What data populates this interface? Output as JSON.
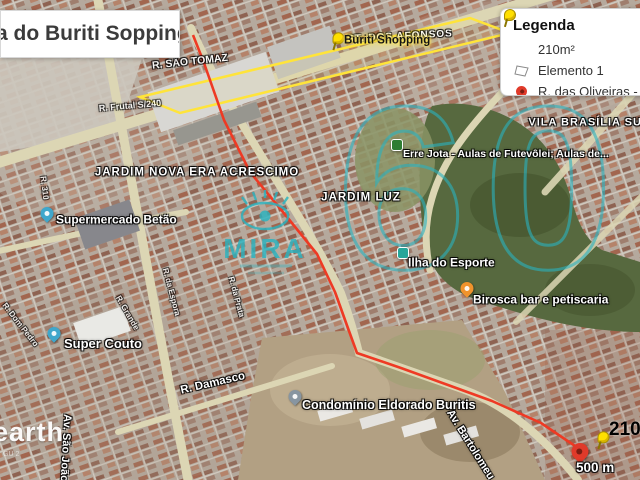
{
  "title": {
    "text": "a do Buriti Sopping"
  },
  "legend": {
    "heading": "Legenda",
    "items": [
      {
        "icon": "yellow-pushpin-icon",
        "label": "210m²"
      },
      {
        "icon": "polygon-icon",
        "label": "Elemento 1"
      },
      {
        "icon": "red-pin-icon",
        "label": "R. das Oliveiras - Jard"
      }
    ]
  },
  "map": {
    "areas": {
      "st_dos_afonsos": "ST. DOS AFONSOS",
      "vila_brasilia_sul": "VILA BRASÍLIA SUL",
      "jardim_nova_era": "JARDIM NOVA ERA ACRESCIMO",
      "jardim_luz": "JARDIM LUZ"
    },
    "streets": {
      "r_sao_tomaz": "R. SÃO TOMAZ",
      "r_frutal": "R. Frutal S/240",
      "r_damasco": "R. Damasco",
      "av_sao_joao": "Av. São João",
      "av_bartolomeu": "Av. Bartolomeu",
      "r_da_espora": "R. da Espora",
      "r_da_prata": "R. da Prata",
      "r_dom_pedro": "R. Dom Pedro",
      "r_grande": "R. Grande",
      "r_310": "R. 310"
    },
    "pois": {
      "buriti_shopping": "Buriti Shopping",
      "supermercado_betao": "Supermercado Betão",
      "super_couto": "Super Couto",
      "ilha_do_esporte": "Ilha do Esporte",
      "birosca": "Birosca bar e petiscaria",
      "erre_jota": "Erre Jota - Aulas de Futevôlei; Aulas de...",
      "condominio": "Condomínio Eldorado Buritis"
    },
    "destination": {
      "label": "210m²"
    },
    "scale_text": "500 m",
    "watermark": {
      "brand": "MIRA",
      "number": "60"
    },
    "earth_logo": "earth",
    "attribution": "GU 2"
  },
  "colors": {
    "route": "#ee3a24",
    "mall_outline": "#ffe43a",
    "watermark": "#2ab3c0",
    "pin_red": "#e03a2a",
    "pushpin_yellow": "#ffdf00"
  }
}
